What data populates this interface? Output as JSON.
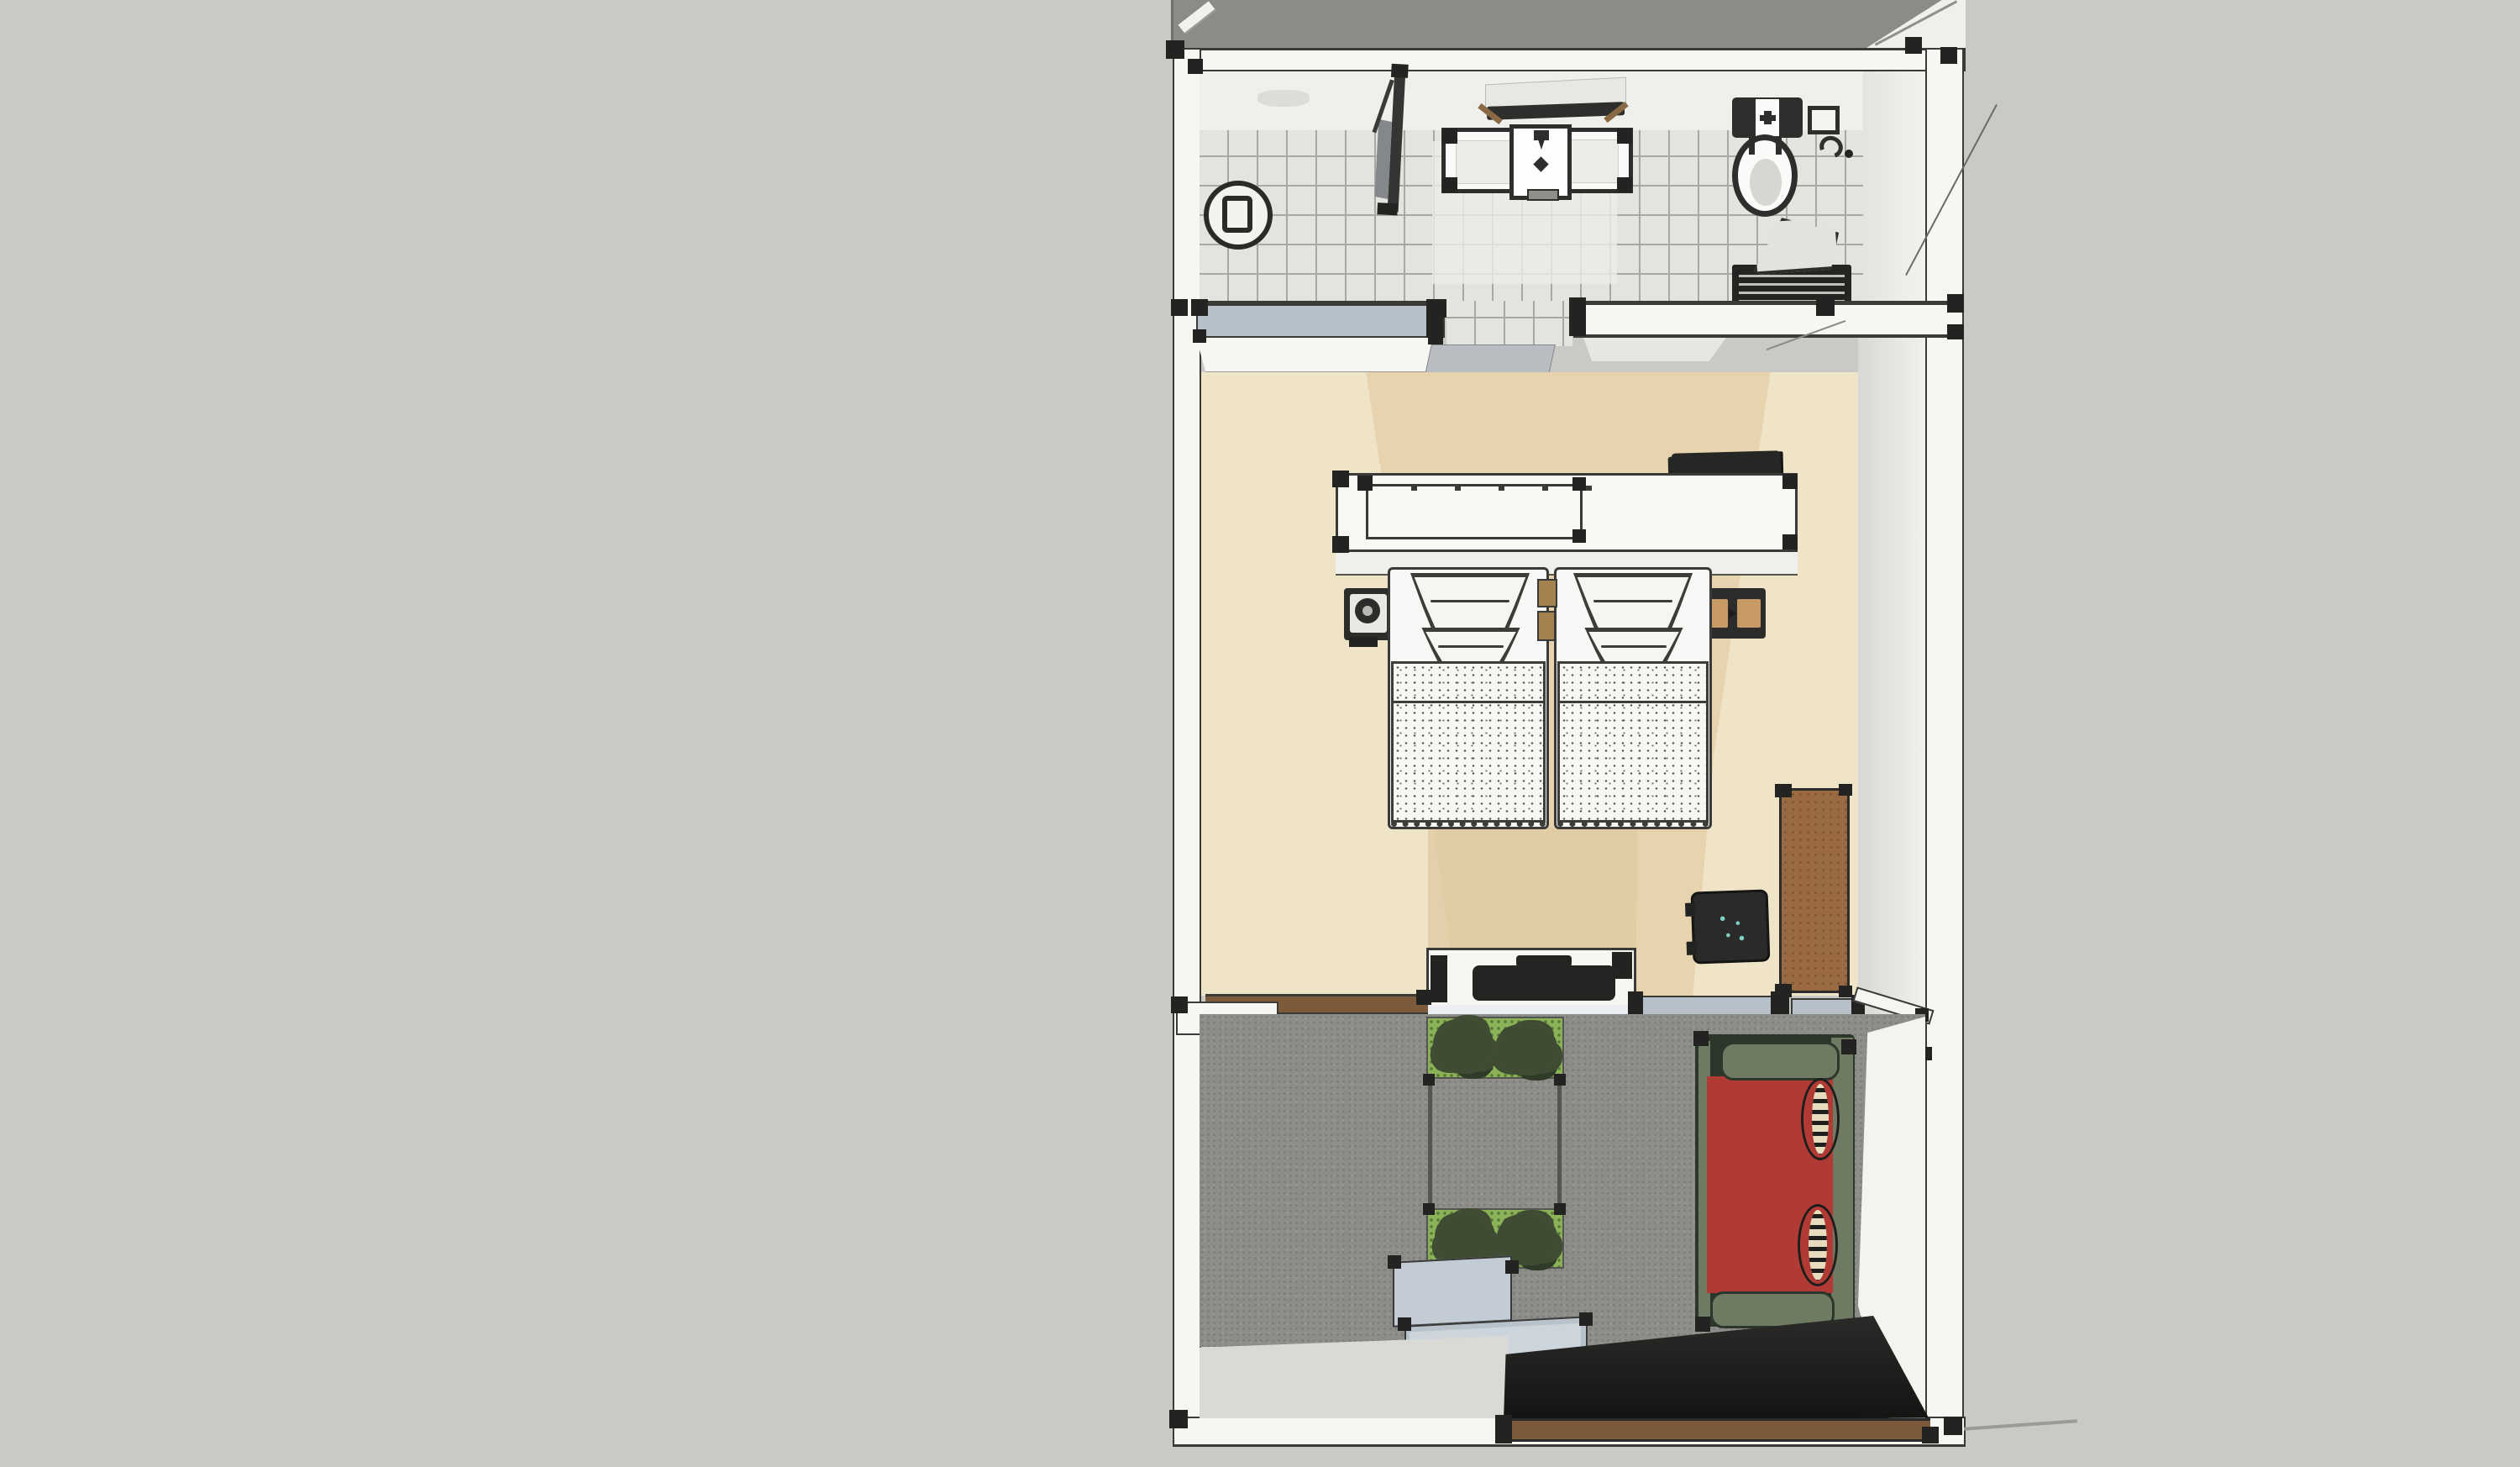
{
  "meta": {
    "title": "Top-down 3D floor plan of a hotel room with bathroom, twin-bed bedroom and balcony terrace"
  },
  "colors": {
    "background": "#c9cac5",
    "exterior_floor": "#8b8b88",
    "wall_fill": "#f6f6f3",
    "wall_line": "#3a3a37",
    "post": "#232321",
    "bathroom_tile": "#e3e3df",
    "tile_line": "#a9a9a3",
    "bathroom_back_wall": "#eff0ec",
    "shower_glass": "#84888b",
    "mirror_glass": "#e7e7e3",
    "bedroom_floor": "#e7d4ae",
    "bedroom_floor_light": "#f0e4c8",
    "bedroom_floor_shade": "#dfcaa2",
    "wall_face": "#d8d8d4",
    "balcony_floor": "#8d8d89",
    "landing_floor": "#d9d9d5",
    "planter_grass": "#8cb258",
    "foliage": "#3f4b33",
    "sofa_seat": "#b23a34",
    "sofa_frame": "#6f7a62",
    "sofa_pillow": "#e8dcbe",
    "bench_blue": "#c3ccd4",
    "sill_blue": "#b6c0c8",
    "threshold_brown": "#7c5a3c",
    "cabinet_brown": "#9a6b42",
    "fixture_dark": "#2e2e2c",
    "porcelain": "#fafaf8",
    "mat_dark": "#1e1e1c",
    "duvet_white": "#f7f7f4",
    "nightstand_wood": "#c69a62",
    "chair_accent": "#7fd0c4"
  },
  "scene": {
    "view": "top-down-3d-plan",
    "rooms": [
      {
        "name": "bathroom",
        "furniture": [
          "floor-drain",
          "shower-screen",
          "vanity-counter",
          "sink",
          "mirror",
          "toilet",
          "toilet-paper-holder",
          "bath-mat-with-towel"
        ]
      },
      {
        "name": "bedroom",
        "furniture": [
          "headboard-console",
          "console-tray",
          "folded-blanket",
          "nightstand-left",
          "wall-lamp",
          "nightstand-right",
          "twin-bed-left",
          "twin-bed-right",
          "luggage-bench",
          "bench-bag",
          "desk-chair",
          "tall-cabinet"
        ]
      },
      {
        "name": "balcony",
        "furniture": [
          "planter-box-upper",
          "planter-box-lower",
          "trellis-screen",
          "storage-step-bench",
          "red-daybed-sofa",
          "round-bolster-pillows",
          "entry-mat"
        ]
      }
    ]
  }
}
